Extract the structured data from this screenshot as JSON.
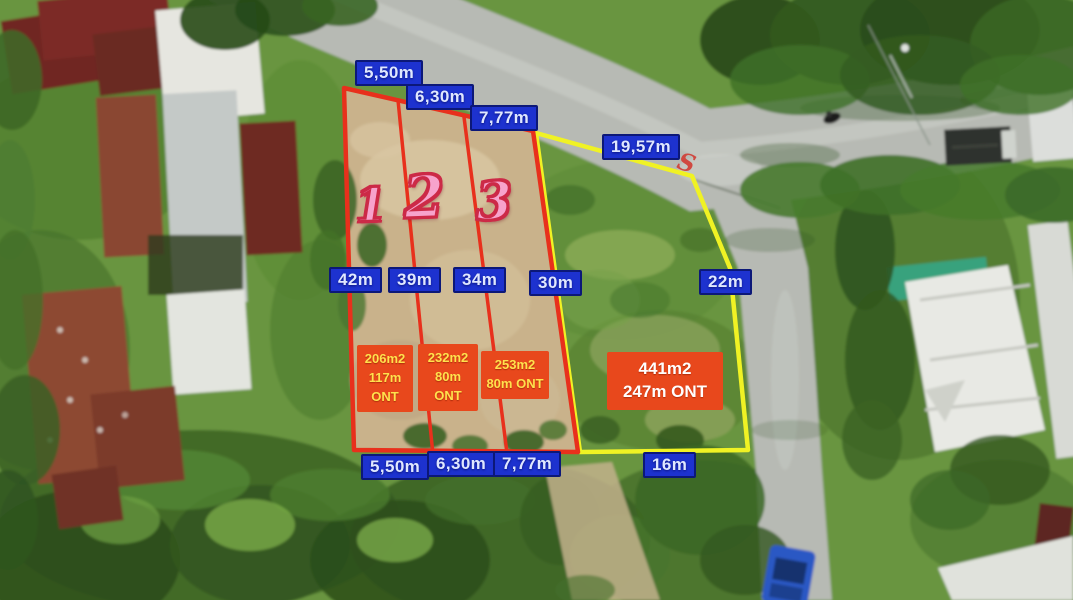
{
  "measurement_labels": {
    "top": [
      "5,50m",
      "6,30m",
      "7,77m",
      "19,57m"
    ],
    "middle": [
      "42m",
      "39m",
      "34m",
      "30m",
      "22m"
    ],
    "bottom": [
      "5,50m",
      "6,30m",
      "7,77m",
      "16m"
    ]
  },
  "plot_numbers": [
    "1",
    "2",
    "3"
  ],
  "plot_details": [
    "206m2\n117m\nONT",
    "232m2\n80m\nONT",
    "253m2\n80m ONT",
    "441m2\n247m ONT"
  ],
  "corner_marker": "S",
  "colors": {
    "measurement_label_bg": "#1d32cf",
    "measurement_label_border": "#0c1878",
    "measurement_label_text": "#dfe7ff",
    "red_plot_outline": "#e8301c",
    "yellow_plot_outline": "#f0f224",
    "detail_box_bg": "#e8481c",
    "detail_box_text_small": "#ffe14d",
    "detail_box_text_large": "#ffffff",
    "plot_number_fill": "#f7a3cc",
    "plot_number_outline": "#cc2a47"
  }
}
